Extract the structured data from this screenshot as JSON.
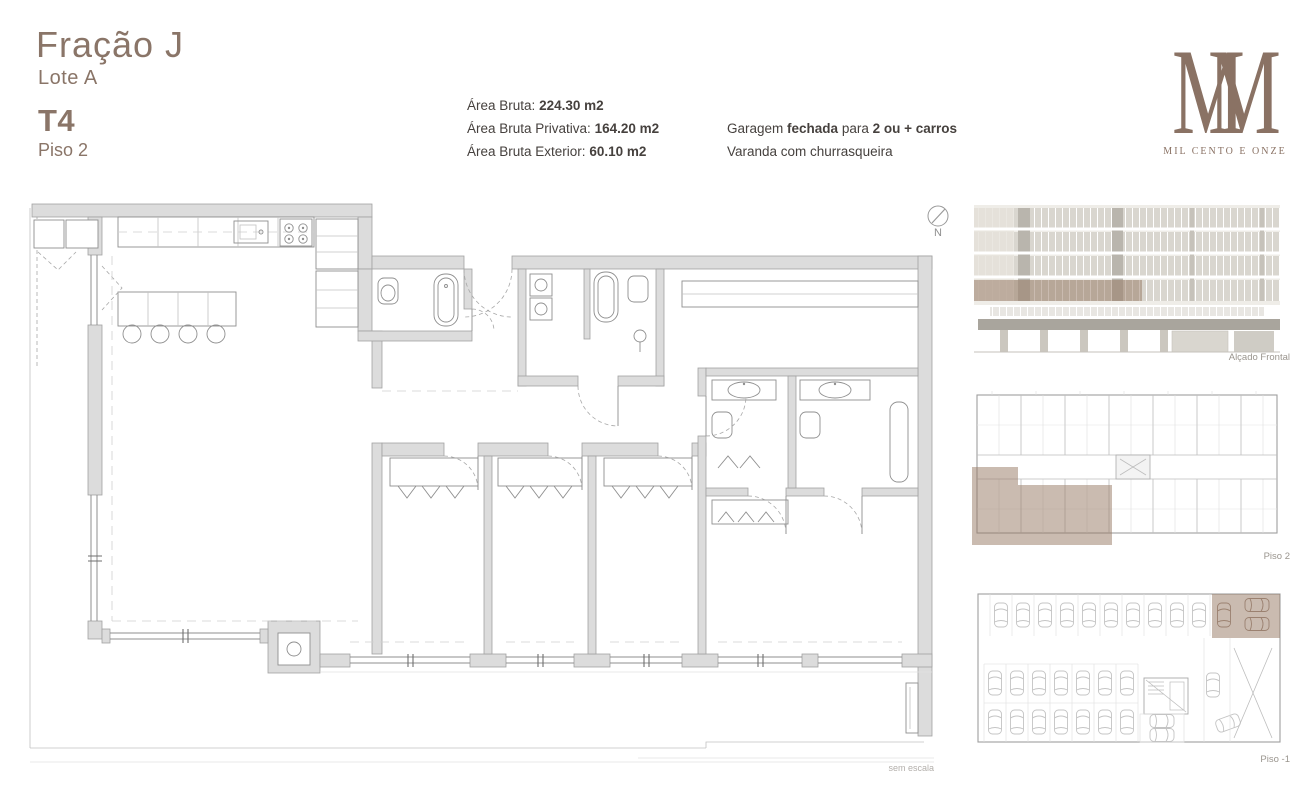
{
  "header": {
    "title": "Fração J",
    "lot": "Lote A",
    "typology": "T4",
    "floor": "Piso 2",
    "areas": [
      {
        "label": "Área Bruta:",
        "value": "224.30 m2"
      },
      {
        "label": "Área Bruta Privativa:",
        "value": "164.20 m2"
      },
      {
        "label": "Área Bruta Exterior:",
        "value": "60.10 m2"
      }
    ],
    "features": {
      "garage_prefix": "Garagem ",
      "garage_bold1": "fechada",
      "garage_mid": " para ",
      "garage_bold2": "2 ou + carros",
      "balcony": "Varanda com churrasqueira"
    }
  },
  "logo": {
    "m1": "M",
    "m2": "M",
    "name": "MIL CENTO E ONZE"
  },
  "plan": {
    "north_label": "N",
    "scale_note": "sem escala"
  },
  "sidebar": {
    "panels": [
      {
        "label": "Alçado Frontal"
      },
      {
        "label": "Piso 2"
      },
      {
        "label": "Piso -1"
      }
    ]
  },
  "colors": {
    "accent_brown": "#8a7568",
    "logo_brown": "#8a7264",
    "highlight_overlay": "rgba(150,119,98,0.5)",
    "wall_gray": "#dcdcdc",
    "text_dark": "#46413e",
    "muted_label": "#9a958e"
  }
}
